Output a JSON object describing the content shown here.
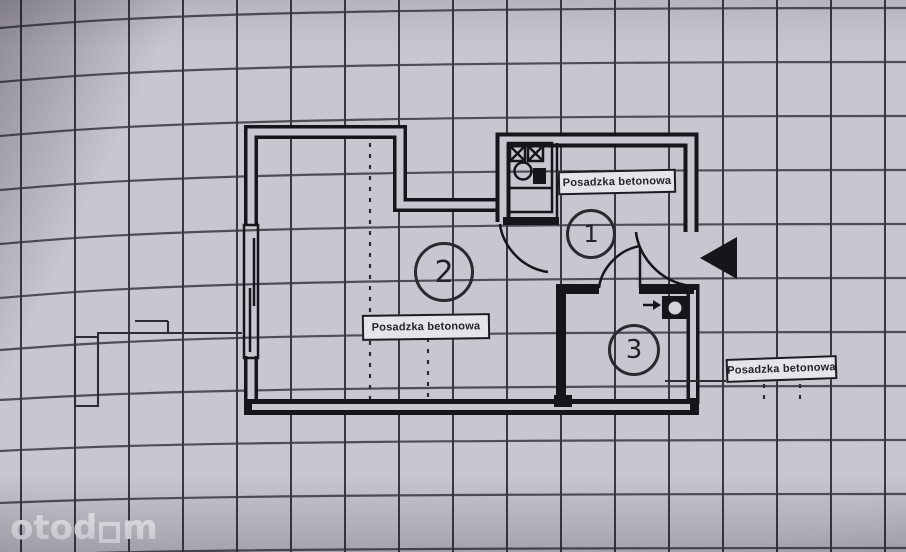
{
  "watermark": {
    "prefix": "otod",
    "suffix": "m"
  },
  "floorplan": {
    "rooms": [
      {
        "number": "1",
        "floor_label": "Posadzka betonowa"
      },
      {
        "number": "2",
        "floor_label": "Posadzka betonowa"
      },
      {
        "number": "3",
        "floor_label": "Posadzka betonowa"
      }
    ]
  },
  "colors": {
    "paper": "#c9c6cf",
    "grid": "#3a3740",
    "ink": "#17141a",
    "label_bg": "#e6e3ea",
    "watermark": "#f5f3f7"
  }
}
